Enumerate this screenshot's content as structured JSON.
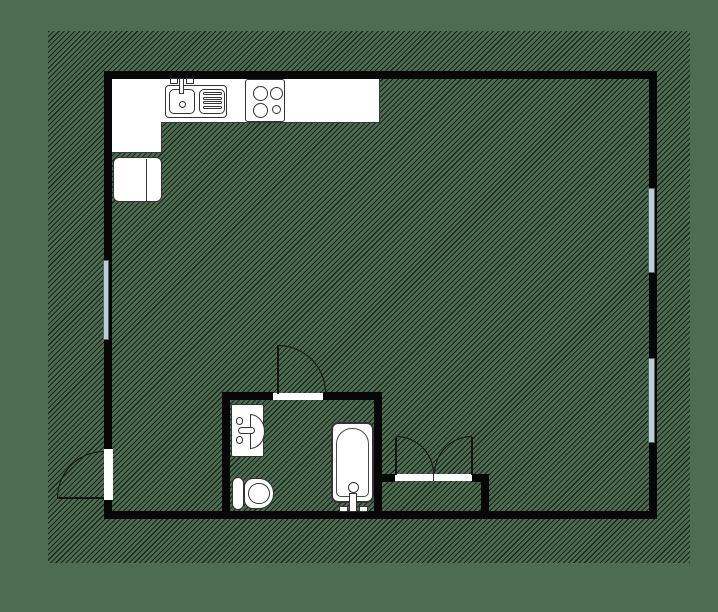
{
  "document": {
    "type": "architectural floor plan",
    "visible_text": [],
    "rooms": [
      "main-room",
      "bathroom",
      "closet"
    ]
  },
  "colors": {
    "canvas_green": "#4d6c51",
    "hatch_line": "#182418",
    "wall_black": "#070707",
    "fixture_fill": "#ffffff",
    "fixture_outline": "#333333",
    "window_glass": "#bccfd4"
  },
  "elements": {
    "walls": [
      "outer-top",
      "outer-left",
      "outer-right",
      "outer-bottom",
      "bathroom-left",
      "bathroom-top",
      "bathroom-right",
      "closet-top",
      "closet-right"
    ],
    "windows": [
      {
        "name": "left-wall-window",
        "wall": "left",
        "count": 1
      },
      {
        "name": "right-wall-window-upper",
        "wall": "right",
        "count": 1
      },
      {
        "name": "right-wall-window-lower",
        "wall": "right",
        "count": 1
      }
    ],
    "doors": [
      {
        "name": "entry-door",
        "wall": "left",
        "type": "single",
        "swing": "outward"
      },
      {
        "name": "bathroom-door",
        "wall": "bathroom-top",
        "type": "single",
        "swing": "into-main-room"
      },
      {
        "name": "closet-double-door",
        "wall": "closet-top",
        "type": "double",
        "swing": "into-main-room"
      }
    ],
    "kitchen_fixtures": [
      "kitchen-counter-l-shape",
      "sink-basin",
      "drainboard",
      "faucet",
      "stove-four-burners",
      "refrigerator"
    ],
    "bathroom_fixtures": [
      "washbasin",
      "toilet",
      "bathtub",
      "tub-faucet"
    ]
  }
}
